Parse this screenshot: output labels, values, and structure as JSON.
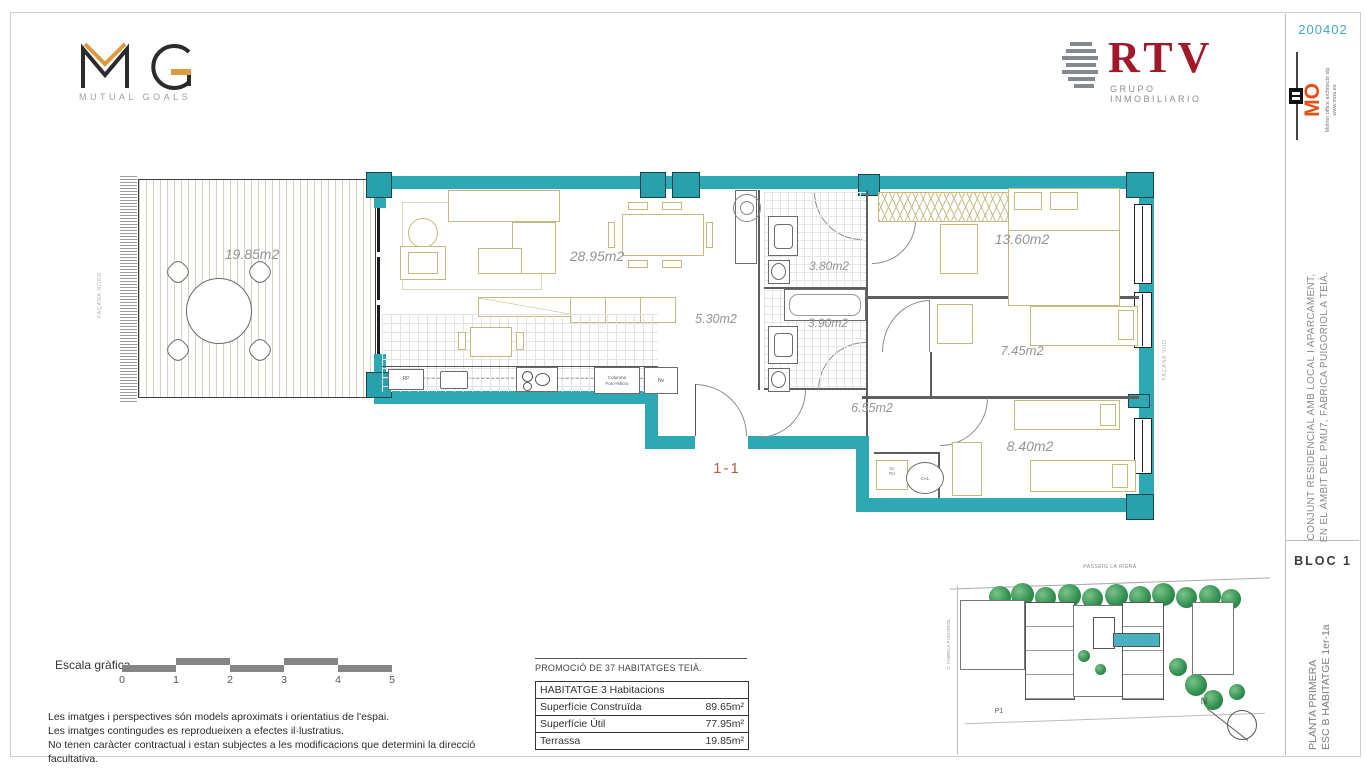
{
  "page": {
    "code": "200402"
  },
  "logos": {
    "mg": {
      "tagline": "MUTUAL GOALS"
    },
    "rtv": {
      "name": "RTV",
      "tagline": "GRUPO INMOBILIARIO"
    },
    "mo": {
      "name": "MO",
      "firm": "Molner office architects slp",
      "web": "www.moa.es"
    }
  },
  "titleblock": {
    "project_line1": "CONJUNT RESIDENCIAL AMB LOCAL I APARCAMENT,",
    "project_line2": "EN EL ÀMBIT DEL PMU7, FÀBRICA PUIGORIOL A TEIÀ.",
    "bloc": "BLOC 1",
    "plan_line1": "PLANTA PRIMERA",
    "plan_line2": "ESC B HABITATGE 1er-1a"
  },
  "plan": {
    "facade_north": "FAÇANA NORD",
    "facade_south": "FAÇANA SUD",
    "unit_label": "1-1",
    "rooms": [
      {
        "name": "terrace",
        "area": "19.85m2"
      },
      {
        "name": "living",
        "area": "28.95m2"
      },
      {
        "name": "kitchen",
        "area": "5.30m2"
      },
      {
        "name": "bath-1",
        "area": "3.80m2"
      },
      {
        "name": "bath-2",
        "area": "3.90m2"
      },
      {
        "name": "bedroom-main",
        "area": "13.60m2"
      },
      {
        "name": "bedroom-2",
        "area": "7.45m2"
      },
      {
        "name": "hall",
        "area": "6.55m2"
      },
      {
        "name": "bedroom-3",
        "area": "8.40m2"
      }
    ],
    "kitchen_labels": {
      "rp": "RP",
      "column": "Columna Forn+Micro",
      "fridge": "Nv"
    },
    "utility_labels": {
      "line1": "Sc",
      "line2": "Rd",
      "boiler": "CAL"
    }
  },
  "scalebar": {
    "label": "Escala gràfica",
    "ticks": [
      "0",
      "1",
      "2",
      "3",
      "4",
      "5"
    ]
  },
  "disclaimer": [
    "Les imatges i perspectives són models aproximats i orientatius de l'espai.",
    "Les imatges contingudes es reprodueixen a efectes il·lustratius.",
    "No tenen caràcter contractual i estan subjectes a les modificacions que determini la direcció facultativa."
  ],
  "summary": {
    "promo": "PROMOCIÓ DE 37 HABITATGES TEIÀ.",
    "table_header": "HABITATGE 3 Habitacions",
    "rows": [
      {
        "label": "Superfície Construïda",
        "value": "89.65m²"
      },
      {
        "label": "Superfície Útil",
        "value": "77.95m²"
      },
      {
        "label": "Terrassa",
        "value": "19.85m²"
      }
    ]
  },
  "siteplan": {
    "street_top": "PASSEIG LA RIERA",
    "street_left": "C. FÀBRICA PUIGORIOL",
    "p1": "P1",
    "north": "N"
  },
  "colors": {
    "wall_teal": "#2ea8b4",
    "accent_orange": "#e84e14",
    "rtv_red": "#a2182b",
    "code_teal": "#45a8c6"
  }
}
